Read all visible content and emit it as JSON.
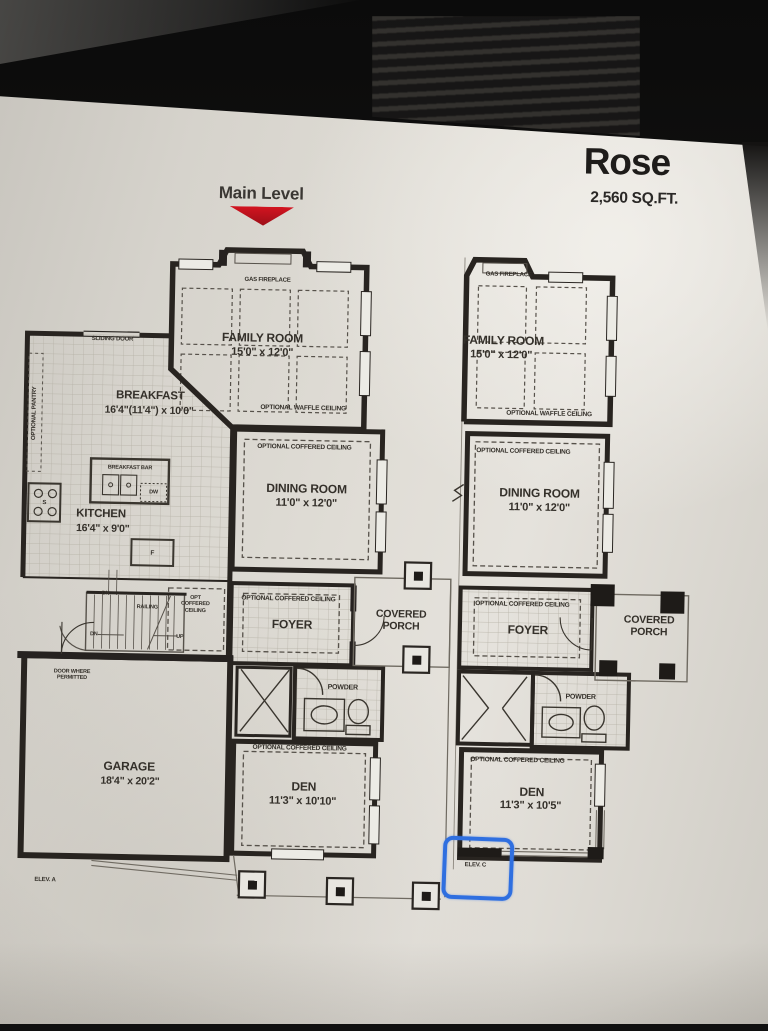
{
  "header": {
    "level_label": "Main Level",
    "plan_name": "Rose",
    "area": "2,560 SQ.FT."
  },
  "left_plan": {
    "elevation": "ELEV. A",
    "gas_fireplace": "GAS FIREPLACE",
    "family_room": {
      "name": "FAMILY ROOM",
      "dims": "15'0\" x 12'0\""
    },
    "optional_waffle_ceiling": "OPTIONAL WAFFLE CEILING",
    "sliding_door": "SLIDING DOOR",
    "optional_pantry": "OPTIONAL PANTRY",
    "breakfast": {
      "name": "BREAKFAST",
      "dims": "16'4\"(11'4\") x 10'0\""
    },
    "breakfast_bar": "BREAKFAST BAR",
    "dishwasher": "DW",
    "stove": "S",
    "fridge": "F",
    "kitchen": {
      "name": "KITCHEN",
      "dims": "16'4\" x 9'0\""
    },
    "dining_room": {
      "name": "DINING ROOM",
      "dims": "11'0\" x 12'0\"",
      "ceiling": "OPTIONAL COFFERED CEILING"
    },
    "opt_coffered_ceiling": "OPT COFFERED CEILING",
    "foyer": {
      "name": "FOYER",
      "ceiling": "OPTIONAL COFFERED CEILING"
    },
    "covered_porch": "COVERED PORCH",
    "stairs": {
      "dn_top": "DN",
      "dn": "DN",
      "up": "UP",
      "railing": "RAILING"
    },
    "door_where_permitted": "DOOR WHERE PERMITTED",
    "garage": {
      "name": "GARAGE",
      "dims": "18'4\" x 20'2\""
    },
    "powder": "POWDER",
    "den": {
      "name": "DEN",
      "dims": "11'3\" x 10'10\"",
      "ceiling": "OPTIONAL COFFERED CEILING"
    }
  },
  "right_plan": {
    "elevation": "ELEV. C",
    "gas_fireplace": "GAS FIREPLACE",
    "family_room": {
      "name": "FAMILY ROOM",
      "dims": "15'0\" x 12'0\""
    },
    "optional_waffle_ceiling": "OPTIONAL WAFFLE CEILING",
    "dining_room": {
      "name": "DINING ROOM",
      "dims": "11'0\" x 12'0\"",
      "ceiling": "OPTIONAL COFFERED CEILING"
    },
    "foyer": {
      "name": "FOYER",
      "ceiling": "OPTIONAL COFFERED CEILING"
    },
    "covered_porch": "COVERED PORCH",
    "powder": "POWDER",
    "den": {
      "name": "DEN",
      "dims": "11'3\" x 10'5\"",
      "ceiling": "OPTIONAL COFFERED CEILING"
    }
  },
  "colors": {
    "accent_red": "#c1121c",
    "marker_blue": "#2f6fe0"
  }
}
